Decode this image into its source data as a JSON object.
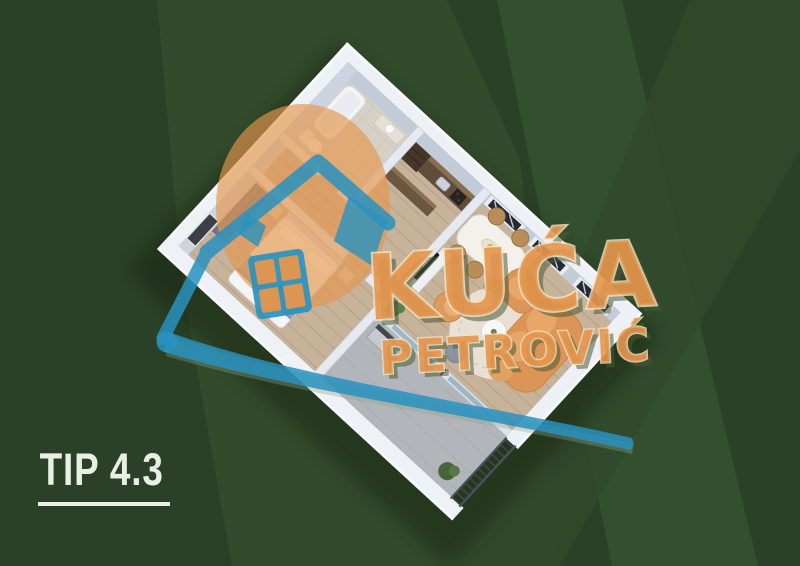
{
  "label": {
    "type_text": "TIP 4.3"
  },
  "watermark": {
    "brand_top": "KUĆA",
    "brand_bottom": "PETROVIĆ"
  },
  "colors": {
    "background": "#2a4127",
    "stripe_light": "#334d2c",
    "stripe_bright": "#33502e",
    "logo_blue": "#2892c0",
    "logo_orange": "#e5964d",
    "text_cream": "#e9efe4"
  }
}
